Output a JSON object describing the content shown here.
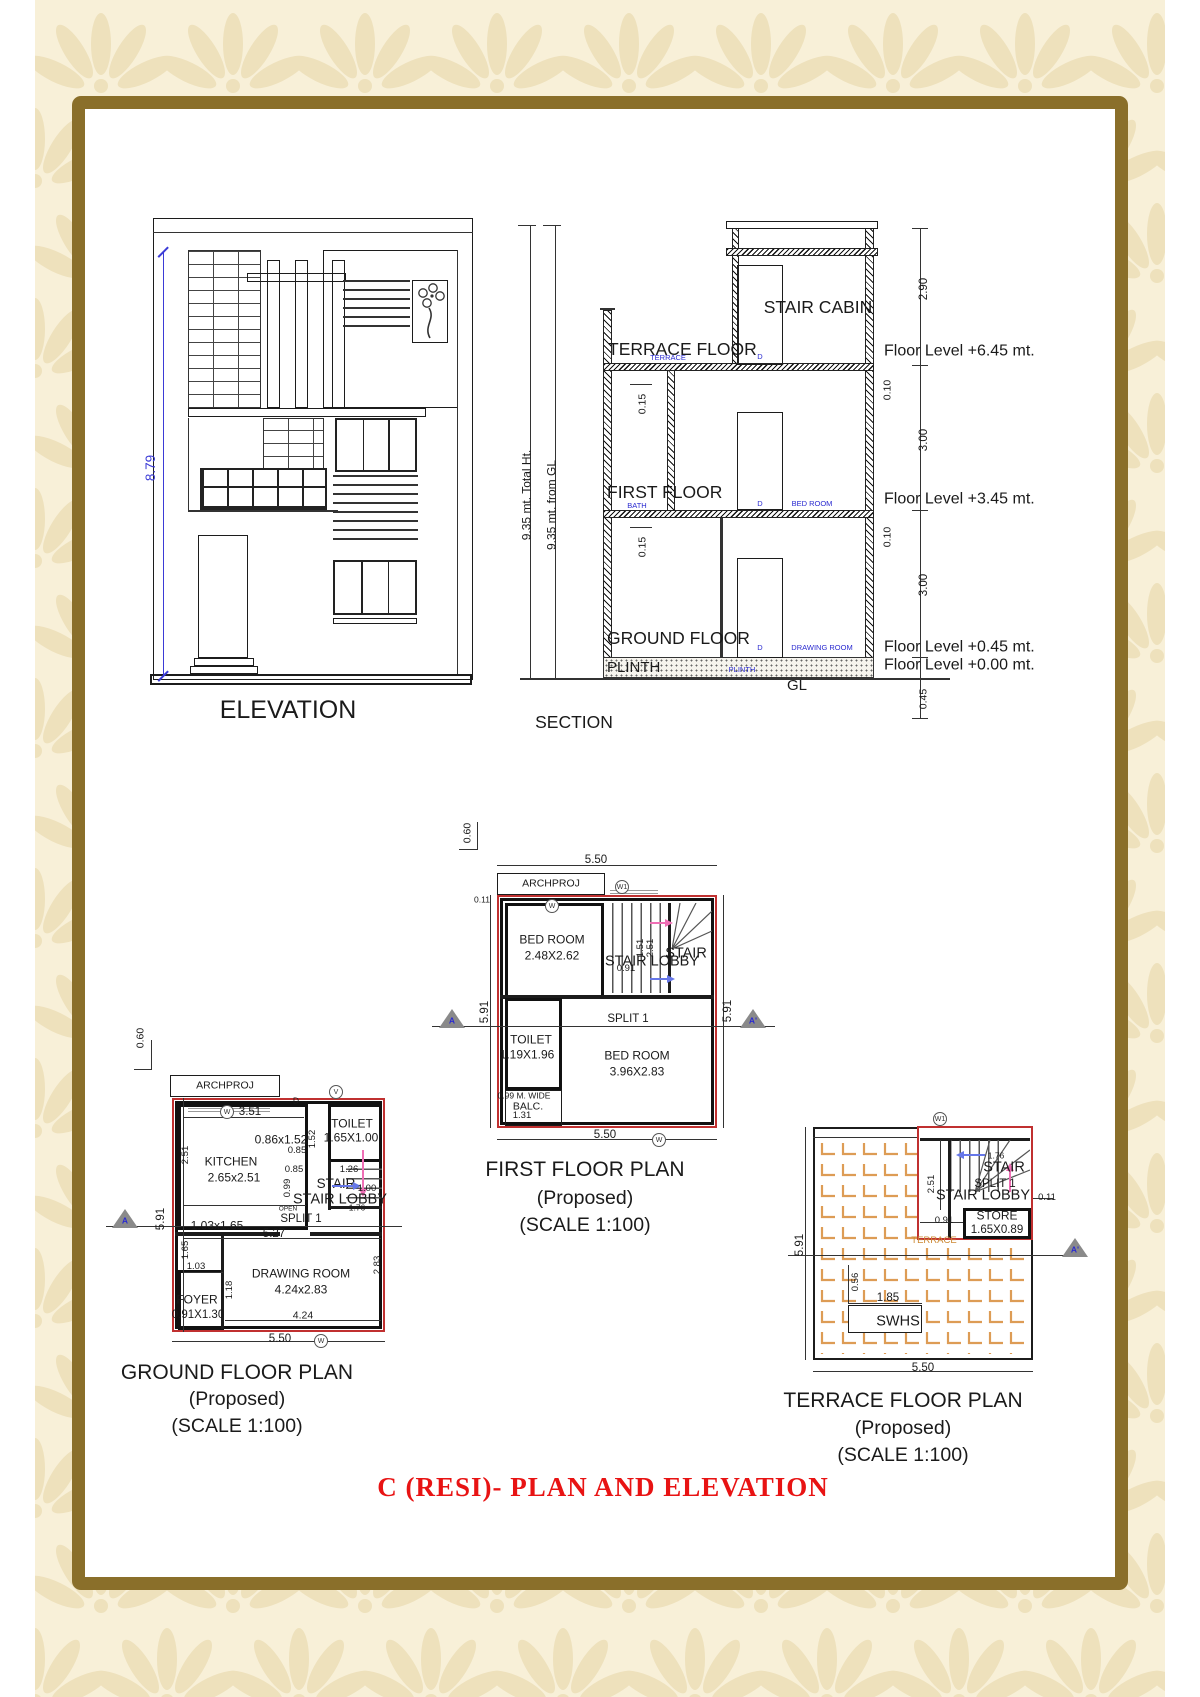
{
  "colors": {
    "frame": "#8a6f2a",
    "pattern_bg": "#f8f0d8",
    "pattern_fan": "#eee1bc",
    "red_outline": "#c03030",
    "blue_label": "#2a2ad0",
    "dim_blue": "#3b3bd6",
    "pink_arrow": "#ef6fb5",
    "blue_arrow": "#6677e8",
    "tile_orange": "#dd9c55",
    "caption_red": "#e81313"
  },
  "caption": "C (RESI)- PLAN AND ELEVATION",
  "elevation": {
    "title": "ELEVATION",
    "height_dim": "8.79"
  },
  "section": {
    "title": "SECTION",
    "stair_cabin": "STAIR CABIN",
    "terrace_floor": "TERRACE FLOOR",
    "first_floor": "FIRST FLOOR",
    "ground_floor": "GROUND FLOOR",
    "plinth": "PLINTH",
    "gl": "GL",
    "total_ht": "9.35 mt. Total Ht.",
    "from_gl": "9.35 mt. from GL",
    "d290": "2.90",
    "d010a": "0.10",
    "d300a": "3.00",
    "d010b": "0.10",
    "d300b": "3.00",
    "d045": "0.45",
    "d015a": "0.15",
    "d015b": "0.15",
    "fl645": "Floor Level +6.45 mt.",
    "fl345": "Floor Level +3.45 mt.",
    "fl045": "Floor Level +0.45 mt.",
    "fl000": "Floor Level +0.00 mt.",
    "b_terrace": "TERRACE",
    "b_d": "D",
    "b_bath": "BATH",
    "b_bed": "BED ROOM",
    "b_drawing": "DRAWING ROOM",
    "b_plinth": "PLINTH"
  },
  "fp": {
    "title": "FIRST FLOOR PLAN",
    "proposed": "(Proposed)",
    "scale": "(SCALE 1:100)",
    "archproj": "ARCHPROJ",
    "d060": "0.60",
    "d550t": "5.50",
    "d011": "0.11",
    "d591l": "5.91",
    "d591r": "5.91",
    "bed1": "BED ROOM",
    "bed1s": "2.48X2.62",
    "stair": "STAIR",
    "lobby": "STAIR LOBBY",
    "d091": "0.91",
    "d151": "1.51",
    "d251": "2.51",
    "split": "SPLIT 1",
    "toilet": "TOILET",
    "toilets": "1.19X1.96",
    "bed2": "BED ROOM",
    "bed2s": "3.96X2.83",
    "balc1": "0.99 M. WIDE",
    "balc2": "BALC.",
    "balc3": "1.31",
    "d550b": "5.50",
    "w": "W",
    "w1": "W1",
    "a": "A",
    "a1": "A'"
  },
  "gp": {
    "title": "GROUND FLOOR PLAN",
    "proposed": "(Proposed)",
    "scale": "(SCALE 1:100)",
    "archproj": "ARCHPROJ",
    "d060": "0.60",
    "d351": "3.51",
    "d0861": "0.86x1.52",
    "d152": "1.52",
    "toilet": "TOILET",
    "toilets": "1.65X1.00",
    "d085a": "0.85",
    "d085b": "0.85",
    "d099": "0.99",
    "d126": "1.26",
    "kitchen": "KITCHEN",
    "kitchens": "2.65x2.51",
    "d251": "2.51",
    "d265": "2.65",
    "stair": "STAIR",
    "d100": "1.00",
    "lobby": "STAIR LOBBY",
    "d176": "1.76",
    "open": "OPEN",
    "split": "SPLIT 1",
    "d103165": "1.03x1.65",
    "d527": "5.27",
    "d165": "1.65",
    "d103": "1.03",
    "drawing": "DRAWING ROOM",
    "drawings": "4.24x2.83",
    "d283": "2.83",
    "foyer": "FOYER",
    "foyers": "0.91X1.30",
    "d118": "1.18",
    "d424": "4.24",
    "d550": "5.50",
    "d591": "5.91",
    "d": "D",
    "v": "V",
    "w": "W",
    "wb": "W",
    "a": "A"
  },
  "tp": {
    "title": "TERRACE FLOOR PLAN",
    "proposed": "(Proposed)",
    "scale": "(SCALE 1:100)",
    "w1": "W1",
    "stair": "STAIR",
    "split": "SPLIT 1",
    "lobby": "STAIR LOBBY",
    "d176": "1.76",
    "d251": "2.51",
    "d091": "0.91",
    "d011": "0.11",
    "store": "STORE",
    "stores": "1.65X0.89",
    "terrace": "TERRACE",
    "d591": "5.91",
    "d056": "0.56",
    "d185": "1.85",
    "swhs": "SWHS",
    "d550": "5.50",
    "a1": "A'"
  }
}
